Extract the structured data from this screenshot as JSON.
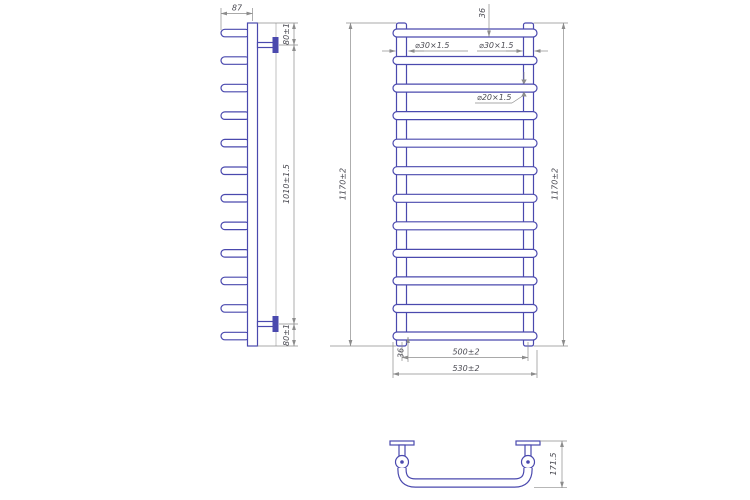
{
  "colors": {
    "tube": "#4a49ae",
    "dimension": "#8c8c8c",
    "text": "#4d4d55",
    "background": "#ffffff"
  },
  "side_view": {
    "dims": {
      "stub_depth": "87",
      "top_bracket_offset": "80±1",
      "bracket_span": "1010±1.5",
      "bottom_bracket_offset": "80±1"
    }
  },
  "front_view": {
    "rung_count": 12,
    "dims": {
      "height_left": "1170±2",
      "height_right": "1170±2",
      "top_rung_gap": "36",
      "bottom_rung_gap": "36",
      "side_tube_left": "⌀30×1.5",
      "side_tube_right": "⌀30×1.5",
      "rung_tube": "⌀20×1.5",
      "axis_width": "500±2",
      "overall_width": "530±2"
    }
  },
  "bottom_view": {
    "dims": {
      "depth": "171.5"
    }
  }
}
